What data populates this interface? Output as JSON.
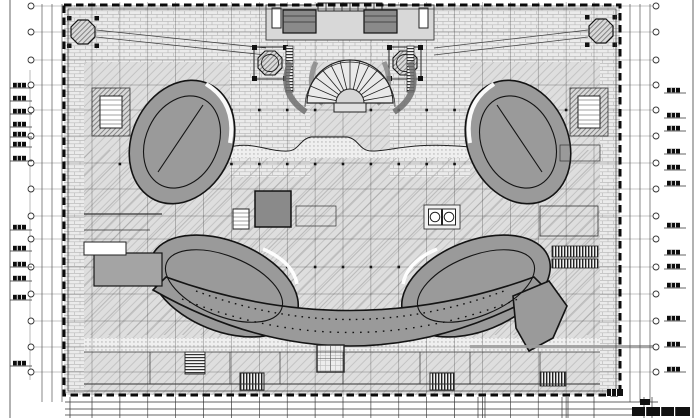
{
  "drawing": {
    "kind": "architectural-cad-floor-plan",
    "sheet": {
      "width": 700,
      "height": 418
    },
    "colors": {
      "paper": "#ffffff",
      "plan_fill": "#dedede",
      "hatch_line": "#c4c4c4",
      "brick_fill": "#ebebeb",
      "brick_line": "#bcbcbc",
      "dark_mass": "#9a9a9a",
      "core_dark": "#8a8a8a",
      "corridor": "#a4a4a4",
      "ink": "#141414",
      "grid_line": "#2e2e2e"
    },
    "building": {
      "x": 64,
      "y": 5,
      "w": 556,
      "h": 390
    },
    "grid": {
      "columns": {
        "count": 19,
        "x0": 92,
        "x1": 594,
        "y0": 2,
        "y1": 418
      },
      "dot_rows": [
        110,
        164,
        267
      ],
      "dot_x_min": 116,
      "dot_x_max": 570
    },
    "axis_bubbles": {
      "left_x": 31,
      "right_x": 656,
      "radius": 3,
      "line_x0": 34,
      "line_x1": 653,
      "rows": [
        6,
        32,
        60,
        85,
        110,
        136,
        163,
        189,
        216,
        239,
        267,
        294,
        321,
        347,
        372
      ]
    },
    "annotation_tags": {
      "left": {
        "x": 10,
        "ys": [
          88,
          101,
          114,
          127,
          137,
          147,
          161,
          230,
          251,
          267,
          281,
          300,
          366
        ]
      },
      "right": {
        "x": 664,
        "ys": [
          93,
          118,
          131,
          154,
          170,
          186,
          228,
          255,
          269,
          288,
          321,
          347,
          372
        ]
      }
    },
    "dimension_lines": {
      "left_xs": [
        42,
        52,
        62
      ],
      "right_xs": [
        630,
        640,
        650
      ],
      "side_y0": 4,
      "side_y1": 402,
      "bottom_ys": [
        402,
        409,
        415
      ],
      "bottom_x0": 65,
      "bottom_x1": 658,
      "bottom_tick_y0": 397,
      "bottom_tick_y1": 418,
      "bottom_extra_xs": [
        70,
        478,
        485,
        562,
        568,
        644,
        652
      ]
    },
    "fan_stair": {
      "cx": 350,
      "cy": 103,
      "r_inner": 14,
      "r_outer": 43,
      "start_deg": 190,
      "end_deg": 350,
      "treads": 13
    }
  }
}
